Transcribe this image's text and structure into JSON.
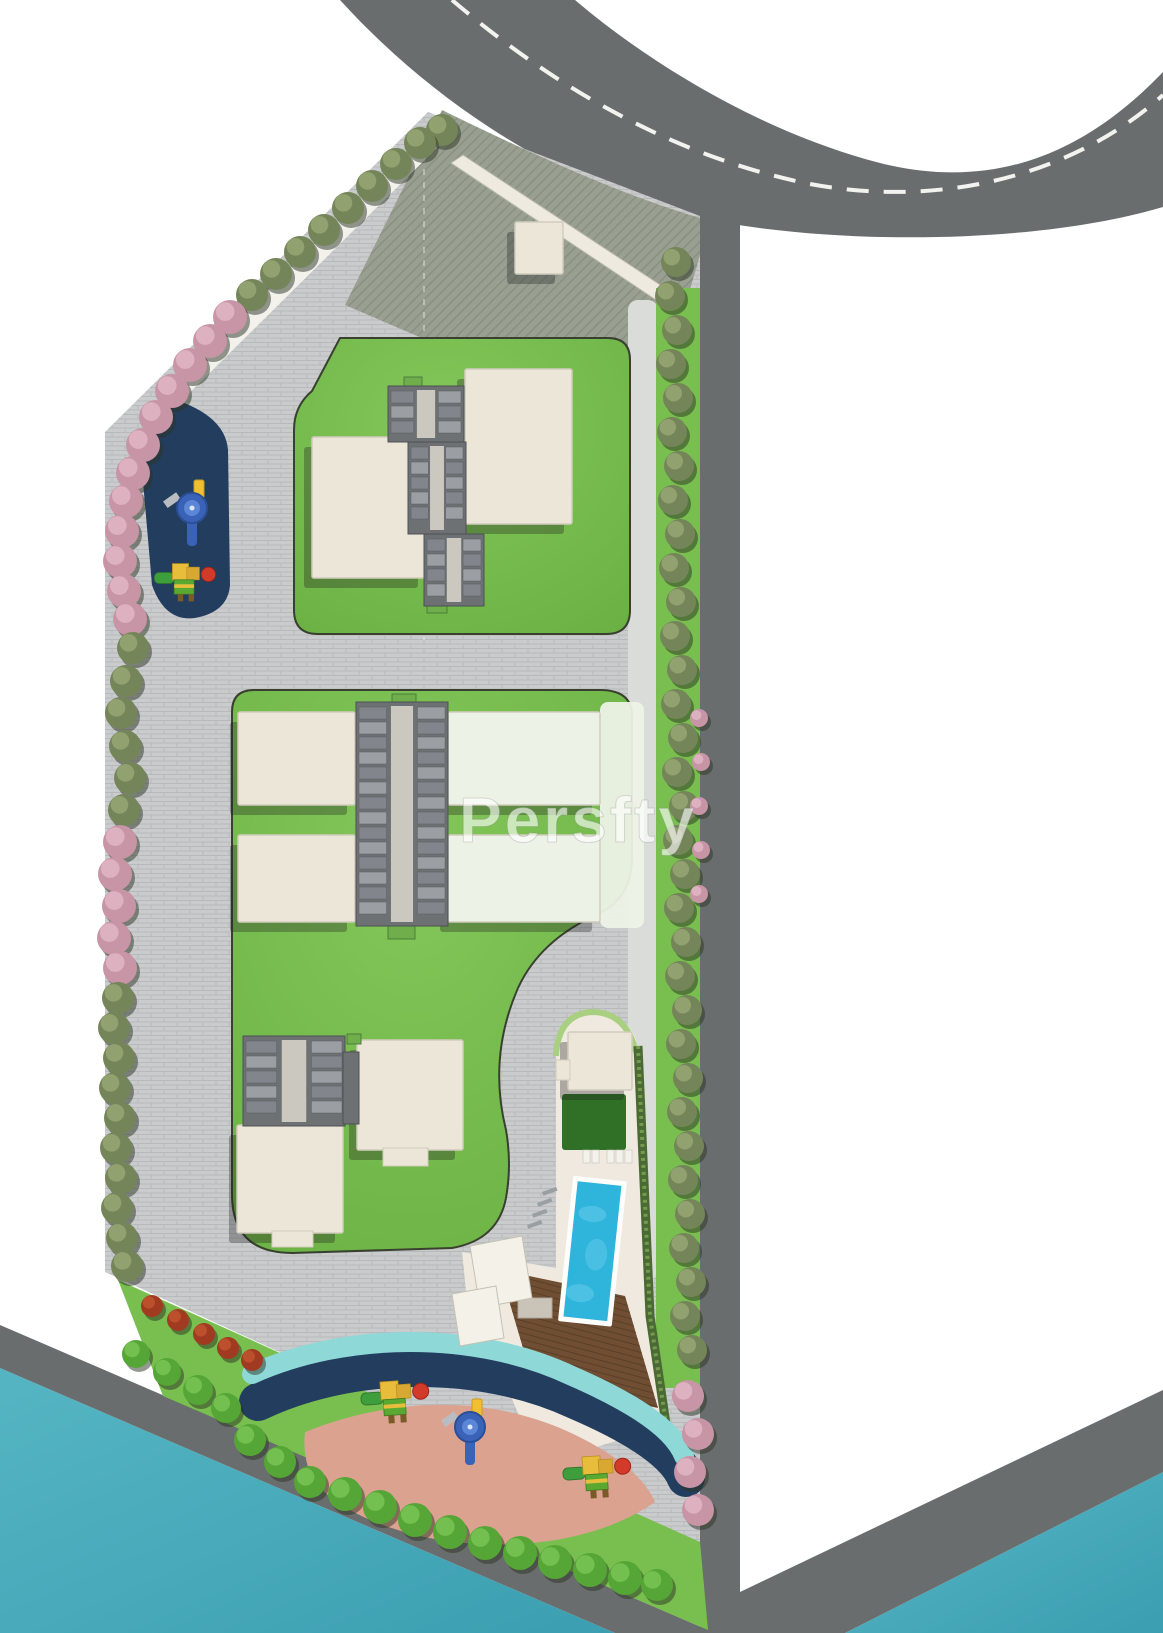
{
  "title": "Residential site master plan",
  "watermark": {
    "text": "Persfty",
    "color": "rgba(255,255,255,0.62)"
  },
  "palette": {
    "bg": "#ffffff",
    "road": "#6a6d6e",
    "road_line": "#f2f2ef",
    "paver": "#c9cbcc",
    "paver_line": "#b7b9bb",
    "gravel": "#dadcda",
    "court": "#99a091",
    "court_line": "#8a9182",
    "sidewalk": "#f3f1ec",
    "canopy": "#eeeae0",
    "lawn": "#6fb546",
    "lawn_hi": "#84c75a",
    "lawn_edge": "#39402f",
    "lawn_dark": "#2f7026",
    "terrace": "#edf2e6",
    "strip_green": "#79bf4f",
    "building": "#ece6d9",
    "building_edge": "#d2ccbd",
    "shadow": "rgba(30,30,30,0.32)",
    "core": "#6e7174",
    "core_edge": "#4e5154",
    "core_corridor": "#cbc8c0",
    "core_unit_a": "#9b9ea2",
    "core_unit_b": "#82858c",
    "water": "#43a7b8",
    "water_hi": "#55b5c3",
    "pool": "#2fb4dc",
    "pool_hi": "#6bcdea",
    "pool_border": "#fdfdfb",
    "deck": "#6f4e33",
    "deck_line": "#5a3f28",
    "teal": "#8fd8d8",
    "navy": "#223d5e",
    "salmon": "#dba28f",
    "hedge": "#4a6a33",
    "hedge_hi": "#77994f",
    "edging": "#a9cf80",
    "tree_green": "#75855a",
    "tree_green_hi": "#97a673",
    "tree_shadow": "#2c3424",
    "tree_pink": "#c795a5",
    "tree_pink_hi": "#e0b6c4",
    "bush": "#55a636",
    "bush_hi": "#79c455",
    "shrub": "#a03a20",
    "shrub_hi": "#c2552f",
    "play_yellow": "#e8bd3c",
    "play_yellow2": "#d9a832",
    "play_green": "#3f9e3c",
    "play_green2": "#58a832",
    "play_red": "#d23a2a",
    "play_blue": "#3a63b8",
    "play_blue_hi": "#5b86d6",
    "play_tower": "#f0c030",
    "lounger_white": "#f4f2ec",
    "lounger_gray": "#9aa0a2",
    "steps": "#c9c3b8"
  },
  "features": {
    "buildings": [
      {
        "name": "block-a1",
        "x": 312,
        "y": 437,
        "w": 114,
        "h": 141,
        "pale": false
      },
      {
        "name": "block-a2",
        "x": 465,
        "y": 369,
        "w": 107,
        "h": 155,
        "pale": false
      },
      {
        "name": "block-b1",
        "x": 238,
        "y": 712,
        "w": 117,
        "h": 93,
        "pale": false
      },
      {
        "name": "block-b2",
        "x": 238,
        "y": 835,
        "w": 117,
        "h": 87,
        "pale": false
      },
      {
        "name": "block-b3",
        "x": 448,
        "y": 712,
        "w": 152,
        "h": 93,
        "pale": true
      },
      {
        "name": "block-b4",
        "x": 448,
        "y": 835,
        "w": 152,
        "h": 87,
        "pale": true
      },
      {
        "name": "block-c1",
        "x": 357,
        "y": 1040,
        "w": 106,
        "h": 110,
        "pale": false
      },
      {
        "name": "block-c2",
        "x": 237,
        "y": 1125,
        "w": 106,
        "h": 108,
        "pale": false
      },
      {
        "name": "pool-house",
        "x": 568,
        "y": 1032,
        "w": 64,
        "h": 58,
        "pale": false
      },
      {
        "name": "entry-kiosk",
        "x": 515,
        "y": 222,
        "w": 48,
        "h": 52,
        "pale": false
      }
    ],
    "tabs": [
      {
        "x": 383,
        "y": 1148,
        "w": 45,
        "h": 18
      },
      {
        "x": 272,
        "y": 1231,
        "w": 41,
        "h": 16
      },
      {
        "x": 556,
        "y": 1060,
        "w": 14,
        "h": 20
      }
    ],
    "green_tabs": [
      {
        "x": 392,
        "y": 694,
        "w": 24,
        "h": 11
      },
      {
        "x": 388,
        "y": 926,
        "w": 27,
        "h": 13
      },
      {
        "x": 404,
        "y": 377,
        "w": 18,
        "h": 10
      },
      {
        "x": 427,
        "y": 603,
        "w": 20,
        "h": 10
      },
      {
        "x": 347,
        "y": 1034,
        "w": 14,
        "h": 10
      }
    ],
    "cores": [
      {
        "x": 388,
        "y": 386,
        "w": 76,
        "h": 56
      },
      {
        "x": 408,
        "y": 442,
        "w": 58,
        "h": 92
      },
      {
        "x": 424,
        "y": 534,
        "w": 60,
        "h": 72
      },
      {
        "x": 356,
        "y": 702,
        "w": 92,
        "h": 224
      },
      {
        "x": 243,
        "y": 1036,
        "w": 102,
        "h": 90
      },
      {
        "x": 343,
        "y": 1052,
        "w": 16,
        "h": 72
      }
    ],
    "trees": [
      [
        442,
        130,
        16,
        "g"
      ],
      [
        420,
        143,
        16,
        "g"
      ],
      [
        396,
        164,
        16,
        "g"
      ],
      [
        372,
        186,
        16,
        "g"
      ],
      [
        348,
        208,
        16,
        "g"
      ],
      [
        324,
        230,
        16,
        "g"
      ],
      [
        300,
        252,
        16,
        "g"
      ],
      [
        276,
        274,
        16,
        "g"
      ],
      [
        252,
        295,
        16,
        "g"
      ],
      [
        230,
        317,
        17,
        "p"
      ],
      [
        210,
        341,
        17,
        "p"
      ],
      [
        190,
        365,
        17,
        "p"
      ],
      [
        172,
        391,
        17,
        "p"
      ],
      [
        156,
        417,
        17,
        "p"
      ],
      [
        143,
        445,
        17,
        "p"
      ],
      [
        133,
        473,
        17,
        "p"
      ],
      [
        126,
        501,
        17,
        "p"
      ],
      [
        122,
        531,
        17,
        "p"
      ],
      [
        120,
        561,
        17,
        "p"
      ],
      [
        124,
        591,
        17,
        "p"
      ],
      [
        130,
        619,
        17,
        "p"
      ],
      [
        133,
        648,
        16,
        "g"
      ],
      [
        126,
        681,
        16,
        "g"
      ],
      [
        121,
        713,
        16,
        "g"
      ],
      [
        125,
        746,
        16,
        "g"
      ],
      [
        130,
        778,
        16,
        "g"
      ],
      [
        124,
        810,
        16,
        "g"
      ],
      [
        120,
        842,
        17,
        "p"
      ],
      [
        115,
        874,
        17,
        "p"
      ],
      [
        119,
        906,
        17,
        "p"
      ],
      [
        114,
        938,
        17,
        "p"
      ],
      [
        120,
        968,
        17,
        "p"
      ],
      [
        118,
        998,
        16,
        "g"
      ],
      [
        114,
        1028,
        16,
        "g"
      ],
      [
        119,
        1058,
        16,
        "g"
      ],
      [
        115,
        1088,
        16,
        "g"
      ],
      [
        120,
        1118,
        16,
        "g"
      ],
      [
        116,
        1148,
        16,
        "g"
      ],
      [
        121,
        1178,
        16,
        "g"
      ],
      [
        117,
        1208,
        16,
        "g"
      ],
      [
        122,
        1238,
        16,
        "g"
      ],
      [
        127,
        1266,
        16,
        "g"
      ],
      [
        676,
        262,
        15,
        "g"
      ],
      [
        670,
        296,
        15,
        "g"
      ],
      [
        677,
        330,
        15,
        "g"
      ],
      [
        671,
        364,
        15,
        "g"
      ],
      [
        678,
        398,
        15,
        "g"
      ],
      [
        672,
        432,
        15,
        "g"
      ],
      [
        679,
        466,
        15,
        "g"
      ],
      [
        673,
        500,
        15,
        "g"
      ],
      [
        680,
        534,
        15,
        "g"
      ],
      [
        674,
        568,
        15,
        "g"
      ],
      [
        681,
        602,
        15,
        "g"
      ],
      [
        675,
        636,
        15,
        "g"
      ],
      [
        682,
        670,
        15,
        "g"
      ],
      [
        676,
        704,
        15,
        "g"
      ],
      [
        683,
        738,
        15,
        "g"
      ],
      [
        677,
        772,
        15,
        "g"
      ],
      [
        684,
        806,
        15,
        "g"
      ],
      [
        678,
        840,
        15,
        "g"
      ],
      [
        685,
        874,
        15,
        "g"
      ],
      [
        679,
        908,
        15,
        "g"
      ],
      [
        686,
        942,
        15,
        "g"
      ],
      [
        680,
        976,
        15,
        "g"
      ],
      [
        687,
        1010,
        15,
        "g"
      ],
      [
        681,
        1044,
        15,
        "g"
      ],
      [
        688,
        1078,
        15,
        "g"
      ],
      [
        682,
        1112,
        15,
        "g"
      ],
      [
        689,
        1146,
        15,
        "g"
      ],
      [
        683,
        1180,
        15,
        "g"
      ],
      [
        690,
        1214,
        15,
        "g"
      ],
      [
        684,
        1248,
        15,
        "g"
      ],
      [
        691,
        1282,
        15,
        "g"
      ],
      [
        685,
        1316,
        15,
        "g"
      ],
      [
        692,
        1350,
        15,
        "g"
      ],
      [
        699,
        718,
        9,
        "p"
      ],
      [
        701,
        762,
        9,
        "p"
      ],
      [
        699,
        806,
        9,
        "p"
      ],
      [
        701,
        850,
        9,
        "p"
      ],
      [
        699,
        894,
        9,
        "p"
      ],
      [
        688,
        1396,
        16,
        "p"
      ],
      [
        698,
        1434,
        16,
        "p"
      ],
      [
        690,
        1472,
        16,
        "p"
      ],
      [
        698,
        1510,
        16,
        "p"
      ]
    ],
    "bushes": [
      [
        136,
        1354,
        14
      ],
      [
        167,
        1372,
        14
      ],
      [
        198,
        1390,
        15
      ],
      [
        226,
        1408,
        15
      ],
      [
        250,
        1440,
        16
      ],
      [
        280,
        1462,
        16
      ],
      [
        310,
        1482,
        16
      ],
      [
        345,
        1494,
        17
      ],
      [
        380,
        1507,
        17
      ],
      [
        415,
        1520,
        17
      ],
      [
        450,
        1532,
        17
      ],
      [
        485,
        1543,
        17
      ],
      [
        520,
        1553,
        17
      ],
      [
        555,
        1562,
        17
      ],
      [
        590,
        1570,
        17
      ],
      [
        625,
        1578,
        17
      ],
      [
        657,
        1585,
        16
      ]
    ],
    "shrubs": [
      [
        152,
        1306,
        11
      ],
      [
        178,
        1320,
        11
      ],
      [
        204,
        1334,
        11
      ],
      [
        228,
        1348,
        11
      ],
      [
        252,
        1360,
        11
      ]
    ],
    "playsets": [
      {
        "x": 395,
        "y": 1397,
        "rot": -4,
        "s": 1
      },
      {
        "x": 597,
        "y": 1472,
        "rot": -4,
        "s": 1
      },
      {
        "x": 185,
        "y": 578,
        "rot": 0,
        "s": 0.9
      }
    ],
    "slides": [
      {
        "x": 470,
        "y": 1427
      },
      {
        "x": 192,
        "y": 508
      }
    ],
    "loungers_white": [
      [
        583,
        1150
      ],
      [
        592,
        1150
      ],
      [
        607,
        1150
      ],
      [
        616,
        1150
      ],
      [
        625,
        1150
      ]
    ],
    "loungers_gray": [
      [
        542,
        1192
      ],
      [
        537,
        1203
      ],
      [
        532,
        1214
      ],
      [
        527,
        1225
      ]
    ],
    "canopies": [
      "470,1246 522,1236 532,1298 480,1308",
      "452,1294 496,1286 504,1338 460,1346"
    ]
  }
}
